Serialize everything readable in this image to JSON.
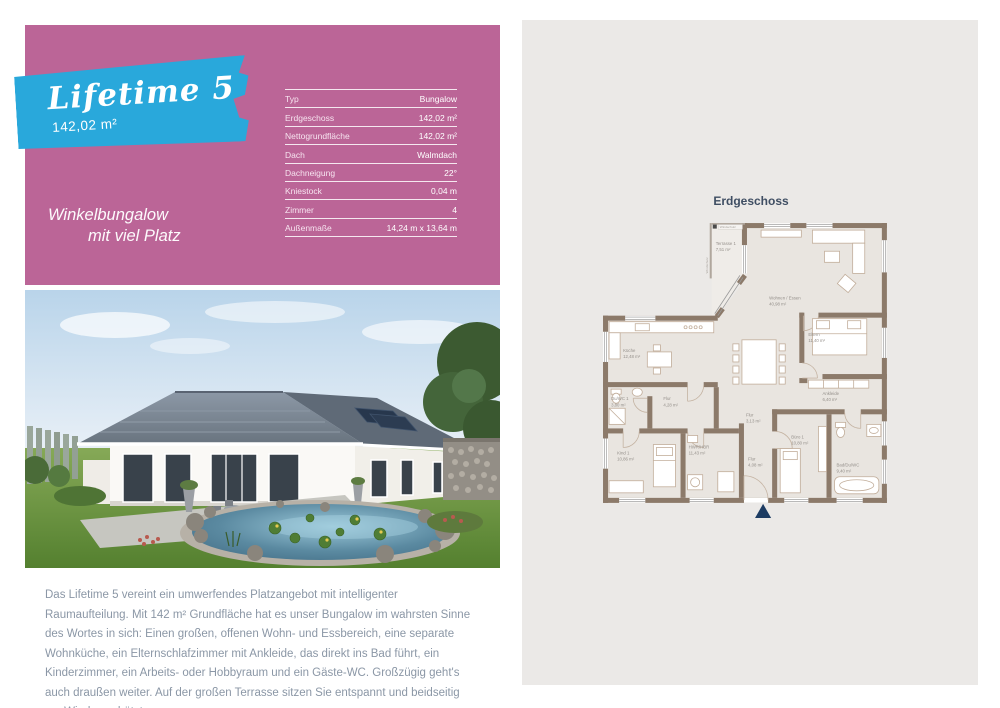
{
  "hero": {
    "title": "Lifetime 5",
    "area": "142,02 m²",
    "tagline_line1": "Winkelbungalow",
    "tagline_line2": "mit viel Platz",
    "colors": {
      "panel": "#bb6597",
      "ribbon": "#29a8db"
    }
  },
  "specs": {
    "rows": [
      {
        "label": "Typ",
        "value": "Bungalow"
      },
      {
        "label": "Erdgeschoss",
        "value": "142,02 m²"
      },
      {
        "label": "Nettogrundfläche",
        "value": "142,02 m²"
      },
      {
        "label": "Dach",
        "value": "Walmdach"
      },
      {
        "label": "Dachneigung",
        "value": "22°"
      },
      {
        "label": "Kniestock",
        "value": "0,04 m"
      },
      {
        "label": "Zimmer",
        "value": "4"
      },
      {
        "label": "Außenmaße",
        "value": "14,24 m x 13,64 m"
      }
    ]
  },
  "floorplan": {
    "title": "Erdgeschoss",
    "wind_label_top": "Windschutz",
    "wind_label_side": "Windschutz",
    "rooms": [
      {
        "name": "Terrasse 1",
        "area": "7,51 m²"
      },
      {
        "name": "Wohnen / Essen",
        "area": "40,98 m²"
      },
      {
        "name": "Küche",
        "area": "12,48 m²"
      },
      {
        "name": "Du/WC 1",
        "area": "3,80 m²"
      },
      {
        "name": "Flur",
        "area": "4,28 m²"
      },
      {
        "name": "Kind 1",
        "area": "10,86 m²"
      },
      {
        "name": "HWR/HBR",
        "area": "11,43 m²"
      },
      {
        "name": "Flur",
        "area": "3,13 m²"
      },
      {
        "name": "Flur",
        "area": "4,08 m²"
      },
      {
        "name": "Büro 1",
        "area": "10,80 m²"
      },
      {
        "name": "Bad/Du/WC",
        "area": "9,40 m²"
      },
      {
        "name": "Ankleide",
        "area": "6,40 m²"
      },
      {
        "name": "Eltern",
        "area": "11,40 m²"
      }
    ],
    "colors": {
      "wall": "#8c7a6a",
      "floor": "#e9e5e0",
      "north_arrow": "#1d3c63"
    }
  },
  "description": {
    "text": "Das Lifetime 5 vereint ein umwerfendes Platzangebot mit intelligenter Raumaufteilung. Mit 142 m² Grundfläche hat es unser Bungalow im wahrsten Sinne des Wortes in sich: Einen großen, offenen Wohn- und Essbereich, eine separate Wohnküche, ein Elternschlafzimmer mit Ankleide, das direkt ins Bad führt, ein Kinderzimmer, ein Arbeits- oder Hobbyraum und ein Gäste-WC. Großzügig geht's auch draußen weiter. Auf der großen Terrasse sitzen Sie entspannt und beidseitig vor Wind geschützt."
  }
}
